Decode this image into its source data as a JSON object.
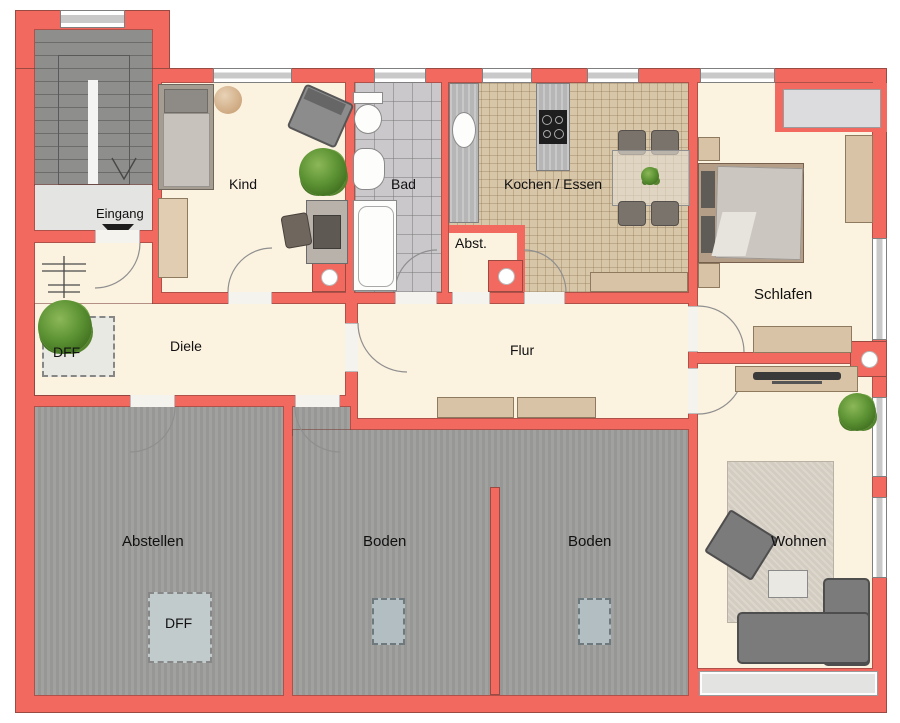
{
  "labels": {
    "eingang": "Eingang",
    "kind": "Kind",
    "bad": "Bad",
    "kochen_essen": "Kochen / Essen",
    "abst": "Abst.",
    "schlafen": "Schlafen",
    "diele": "Diele",
    "flur": "Flur",
    "abstellen": "Abstellen",
    "boden_left": "Boden",
    "boden_right": "Boden",
    "wohnen": "Wohnen",
    "dff_diele": "DFF",
    "dff_abstellen": "DFF"
  },
  "colors": {
    "wall": "#f2695f",
    "wall_edge": "#9a4a41",
    "floor_living": "#fbf2e0",
    "floor_attic": "#9c9c9a",
    "floor_bath_tile": "#cbc8cb",
    "floor_kitchen_tile": "#d8c6a9",
    "stairs": "#8e8e8c",
    "landing": "#e4e4e2",
    "skylight": "#e9e9e4",
    "attic_skylight": "#b2bec1",
    "furniture_wood": "#d8c3a6",
    "furniture_gray": "#7b7b7b",
    "window_white": "#ffffff",
    "window_stripe": "#c9c9c9",
    "text": "#111111"
  }
}
